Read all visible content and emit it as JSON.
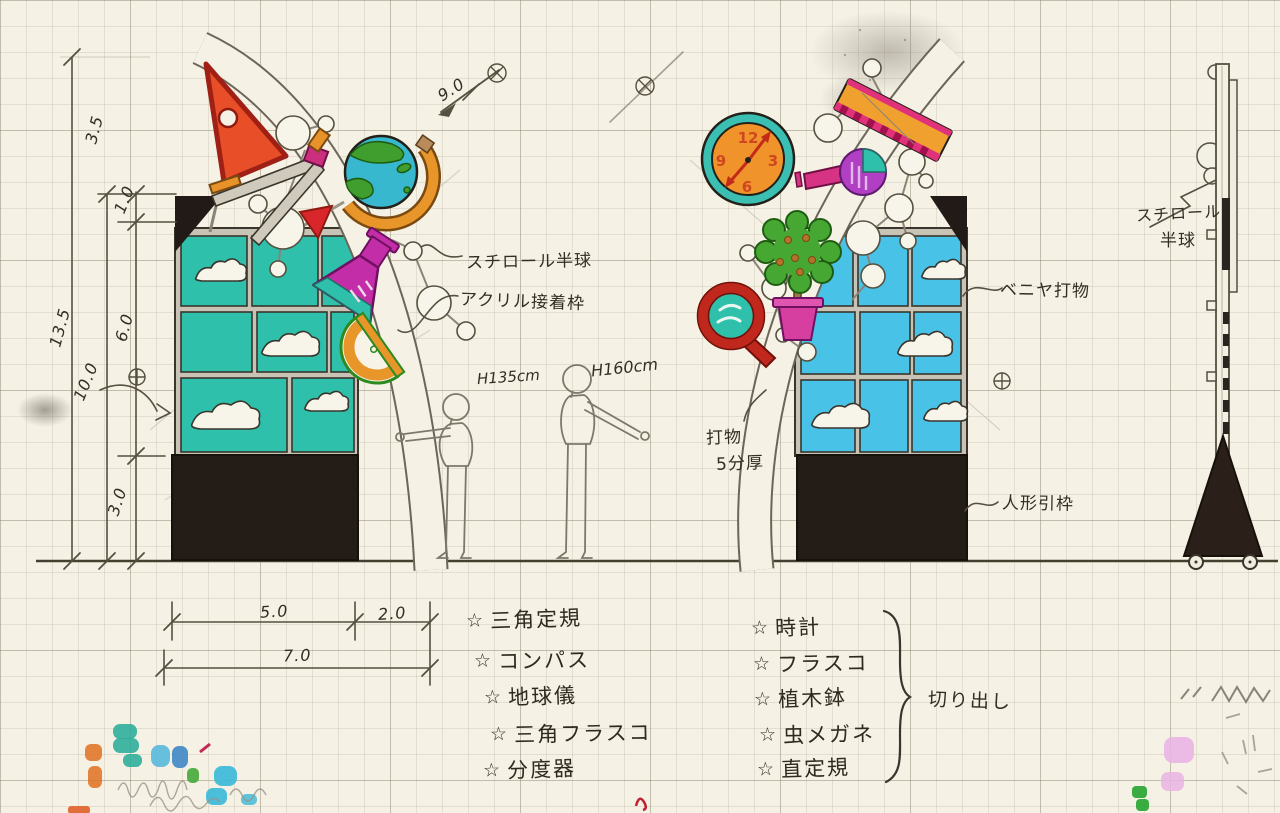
{
  "dimensions": {
    "total_height": "13.5",
    "top_offset": "3.5",
    "gap": "1.0",
    "panel_height": "6.0",
    "structure_height": "10.0",
    "base_height": "3.0",
    "panel_width": "5.0",
    "side_width": "2.0",
    "total_width": "7.0",
    "arc_length": "9.0"
  },
  "annotations": {
    "styrofoam_hemisphere": "スチロール半球",
    "acrylic_bond_frame": "アクリル接着枠",
    "plywood_cutout": "ベニヤ打物",
    "cutout": "打物",
    "cutout_thickness": "5分厚",
    "figure_pull_frame": "人形引枠",
    "side_styrofoam": "スチロール",
    "side_hemisphere": "半球",
    "small_figure_height": "H135cm",
    "large_figure_height": "H160cm"
  },
  "clock": {
    "twelve": "12",
    "three": "3",
    "six": "6",
    "nine": "9"
  },
  "left_parts_list": {
    "bullet": "☆",
    "items": [
      "三角定規",
      "コンパス",
      "地球儀",
      "三角フラスコ",
      "分度器"
    ]
  },
  "right_parts_list": {
    "bullet": "☆",
    "items": [
      "時計",
      "フラスコ",
      "植木鉢",
      "虫メガネ",
      "直定規"
    ],
    "brace_label": "切り出し"
  },
  "colors": {
    "paper": "#f5f1e4",
    "pencil": "#55503f",
    "ink": "#332e24",
    "teal_panel": "#2fc0ab",
    "blue_panel": "#49c2e8",
    "black_base": "#251d17",
    "red": "#d8352a",
    "orange": "#eb9b2d",
    "magenta": "#cc2fa6",
    "purple": "#a93fc4",
    "green": "#46a832",
    "clock_face": "#f0932a",
    "clock_rim": "#3bbfb3",
    "marker_test_colors": [
      "#e07020",
      "#2fae9b",
      "#58b8dc",
      "#3f87c4",
      "#46a838",
      "#38b8d8",
      "#eab4e4",
      "#2fa838"
    ]
  }
}
